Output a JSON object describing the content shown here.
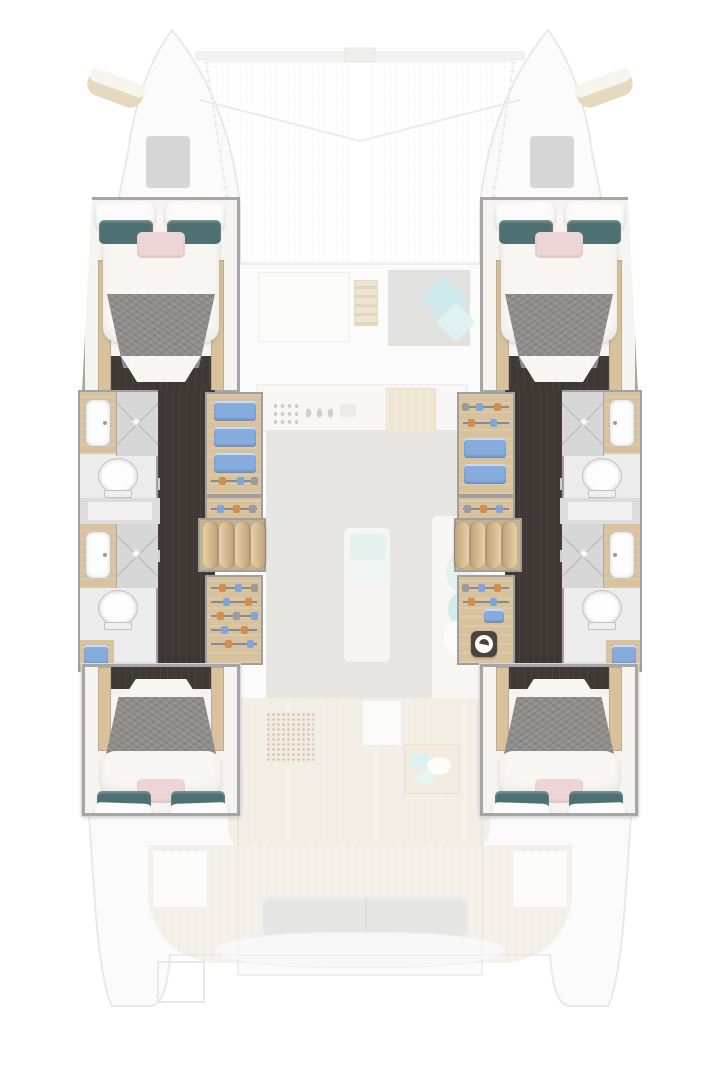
{
  "image": {
    "kind": "yacht-floor-plan",
    "vessel": "catamaran",
    "view": "top-down"
  },
  "palette": {
    "bg": "#ffffff",
    "hull-fill": "#fafaf9",
    "hull-line": "#dcdcdc",
    "hatch": "#b3b3b3",
    "pad-tan": "#d9c29a",
    "wall": "#a6a6a6",
    "wall-light": "#d8d8d8",
    "floor-dark": "#3f3835",
    "wood": "#d8c29e",
    "wood-dark": "#c2a477",
    "duvet": "#f8f6f3",
    "blanket": "#8d8c8a",
    "pillow-white": "#fcfbf9",
    "pillow-teal": "#4f7073",
    "pillow-pink": "#eed5d5",
    "towel-blue": "#86abdd",
    "tile": "#d7d7d7",
    "fixture": "#fdfdfd",
    "fixture-line": "#c2c2c2",
    "bath-bg": "#ececec",
    "window-band": "#dcdcdc",
    "salon-floor": "#d7d2cb",
    "teak": "#efe7da",
    "teak-line": "#e6dac8",
    "mint": "#cfe9e3",
    "cyan": "#a3d8de",
    "bench-grey": "#d2d2d0",
    "counter-white": "#f4f2ef"
  },
  "icons": {
    "sparkle_glyph": "✦"
  },
  "semantics": {
    "highlighted_areas": [
      "port-hull-interior",
      "starboard-hull-interior"
    ],
    "cabins": [
      {
        "id": "forward-port-cabin",
        "furniture": [
          "double-bed",
          "white-pillows",
          "teal-pillows",
          "pink-cushion",
          "grey-blanket",
          "wood-trim",
          "dark-floor"
        ]
      },
      {
        "id": "forward-starboard-cabin",
        "furniture": [
          "double-bed",
          "white-pillows",
          "teal-pillows",
          "pink-cushion",
          "grey-blanket",
          "wood-trim",
          "dark-floor"
        ]
      },
      {
        "id": "aft-port-cabin",
        "furniture": [
          "double-bed",
          "white-pillows",
          "teal-pillows",
          "pink-cushion",
          "grey-blanket",
          "wood-trim",
          "dark-floor"
        ]
      },
      {
        "id": "aft-starboard-cabin",
        "furniture": [
          "double-bed",
          "white-pillows",
          "teal-pillows",
          "pink-cushion",
          "grey-blanket",
          "wood-trim",
          "dark-floor"
        ]
      }
    ],
    "bathrooms": [
      {
        "id": "port-forward-head",
        "fixtures": [
          "sink",
          "shower",
          "toilet"
        ]
      },
      {
        "id": "port-aft-head",
        "fixtures": [
          "sink",
          "shower",
          "toilet"
        ]
      },
      {
        "id": "starboard-forward-head",
        "fixtures": [
          "sink",
          "shower",
          "toilet"
        ]
      },
      {
        "id": "starboard-aft-head",
        "fixtures": [
          "sink",
          "shower",
          "toilet"
        ]
      }
    ],
    "hull_passages": [
      "port-corridor-dark-wood",
      "starboard-corridor-dark-wood"
    ],
    "storage": [
      "towel-shelves",
      "hanging-wardrobes",
      "companionway-steps",
      "washing-machine"
    ],
    "shared_spaces": {
      "forward_lounge": [
        "berth",
        "control-panel",
        "grey-lounge-pad",
        "cyan-cushions"
      ],
      "galley": [
        "stove-burners",
        "control-knobs",
        "double-sink",
        "wood-counter",
        "fridge"
      ],
      "salon": [
        "bench-seats",
        "mint-cushions",
        "dotted-mat",
        "plank-floor",
        "coffee-table"
      ],
      "cockpit": [
        "teak-floor",
        "side-benches",
        "grey-sofa",
        "aft-table",
        "transom-step"
      ],
      "foredeck": [
        "trampoline-mesh",
        "crossbeam",
        "bridle-lines",
        "deck-hatches",
        "bow-pads"
      ]
    }
  }
}
